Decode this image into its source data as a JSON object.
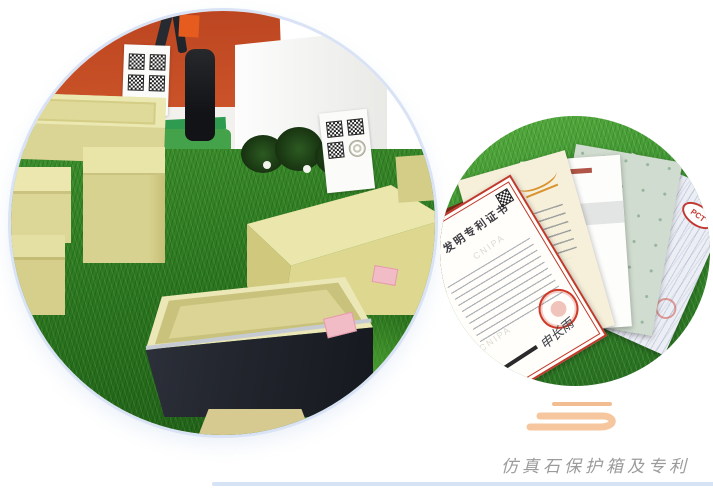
{
  "page": {
    "background": "#ffffff"
  },
  "caption": {
    "text": "仿真石保护箱及专利",
    "color": "#9b9b9b"
  },
  "divider": {
    "color": "#d6e3f4"
  },
  "swirl": {
    "color": "#f6c79e"
  },
  "left_photo": {
    "ring_color": "#d9e3f5",
    "colors": {
      "wall": "#c54e2a",
      "grass": "#2c7a21",
      "boxes": "#dcd695",
      "dark_box": "#20242c",
      "qr_sign": "#fbfbfa",
      "labels": "#f2bcc7"
    }
  },
  "right_photo": {
    "colors": {
      "grass": "#3a9130",
      "folder": "#7c2716",
      "patent_border": "#c0392b",
      "gold_seal": "#cfa645"
    },
    "patent_certificate": {
      "title": "发明专利证书",
      "watermark": "CNIPA",
      "signature": "申长雨"
    },
    "pct_certificate": {
      "logo": "PCT"
    },
    "script_certificate": {
      "glyph": "t"
    }
  }
}
